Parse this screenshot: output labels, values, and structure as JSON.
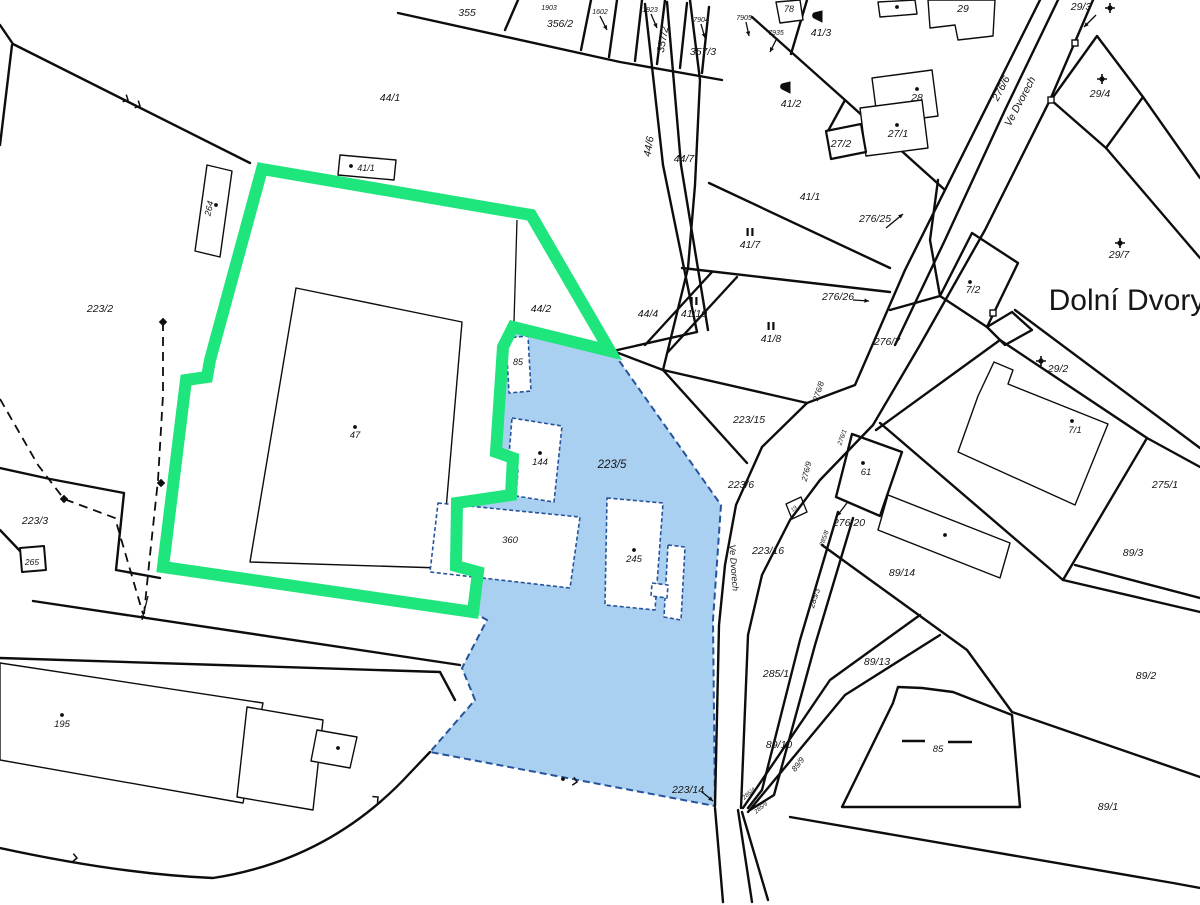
{
  "map": {
    "region_name": "Dolní Dvory",
    "highlight": {
      "parcel": "47",
      "color": "#1ee57c",
      "width": 12
    },
    "selection": {
      "parcel": "223/5",
      "fill": "#a9cff1",
      "border": "#26549b"
    },
    "line_color": "#0d0d0d",
    "street": "Ve Dvorech",
    "labels": [
      {
        "t": "355",
        "x": 467,
        "y": 16
      },
      {
        "t": "356/2",
        "x": 560,
        "y": 27
      },
      {
        "t": "357/2",
        "x": 666,
        "y": 40,
        "r": -80
      },
      {
        "t": "357/3",
        "x": 703,
        "y": 55
      },
      {
        "t": "1903",
        "x": 549,
        "y": 10,
        "s": 7
      },
      {
        "t": "1602",
        "x": 600,
        "y": 14,
        "s": 7
      },
      {
        "t": "1923",
        "x": 650,
        "y": 12,
        "s": 7
      },
      {
        "t": "7904",
        "x": 701,
        "y": 22,
        "s": 7
      },
      {
        "t": "7905",
        "x": 744,
        "y": 20,
        "s": 7
      },
      {
        "t": "7935",
        "x": 776,
        "y": 35,
        "s": 7
      },
      {
        "t": "78",
        "x": 789,
        "y": 12,
        "s": 9
      },
      {
        "t": "41/3",
        "x": 821,
        "y": 36
      },
      {
        "t": "29",
        "x": 963,
        "y": 12
      },
      {
        "t": "41/2",
        "x": 791,
        "y": 107
      },
      {
        "t": "28",
        "x": 917,
        "y": 101
      },
      {
        "t": "27/1",
        "x": 898,
        "y": 137
      },
      {
        "t": "27/2",
        "x": 841,
        "y": 147
      },
      {
        "t": "29/3",
        "x": 1081,
        "y": 10
      },
      {
        "t": "29/4",
        "x": 1100,
        "y": 97
      },
      {
        "t": "29/7",
        "x": 1119,
        "y": 258
      },
      {
        "t": "276/6",
        "x": 1004,
        "y": 90,
        "r": -62
      },
      {
        "t": "Ve Dvorech",
        "x": 1023,
        "y": 103,
        "r": -62
      },
      {
        "t": "44/1",
        "x": 390,
        "y": 101
      },
      {
        "t": "41/1",
        "x": 366,
        "y": 171,
        "s": 9
      },
      {
        "t": "264",
        "x": 212,
        "y": 209,
        "r": -78,
        "s": 9
      },
      {
        "t": "41/1",
        "x": 810,
        "y": 200
      },
      {
        "t": "276/25",
        "x": 875,
        "y": 222
      },
      {
        "t": "44/6",
        "x": 652,
        "y": 147,
        "r": -80
      },
      {
        "t": "44/7",
        "x": 684,
        "y": 162
      },
      {
        "t": "41/7",
        "x": 750,
        "y": 248
      },
      {
        "t": "223/2",
        "x": 100,
        "y": 312
      },
      {
        "t": "44/2",
        "x": 541,
        "y": 312
      },
      {
        "t": "276/26",
        "x": 838,
        "y": 300
      },
      {
        "t": "276/7",
        "x": 887,
        "y": 345
      },
      {
        "t": "7/2",
        "x": 973,
        "y": 293
      },
      {
        "t": "44/4",
        "x": 648,
        "y": 317
      },
      {
        "t": "41/10",
        "x": 694,
        "y": 317
      },
      {
        "t": "41/8",
        "x": 771,
        "y": 342
      },
      {
        "t": "223/15",
        "x": 749,
        "y": 423
      },
      {
        "t": "85",
        "x": 518,
        "y": 365,
        "s": 9
      },
      {
        "t": "223/5",
        "x": 612,
        "y": 468,
        "s": 11.5
      },
      {
        "t": "144",
        "x": 540,
        "y": 465,
        "s": 9.5
      },
      {
        "t": "29/2",
        "x": 1058,
        "y": 372
      },
      {
        "t": "7/1",
        "x": 1075,
        "y": 433,
        "s": 9.5
      },
      {
        "t": "276/8",
        "x": 821,
        "y": 392,
        "r": -72,
        "s": 8
      },
      {
        "t": "275/1",
        "x": 1165,
        "y": 488
      },
      {
        "t": "223/6",
        "x": 741,
        "y": 488
      },
      {
        "t": "61",
        "x": 866,
        "y": 475,
        "s": 9.5
      },
      {
        "t": "276/1",
        "x": 844,
        "y": 438,
        "r": -70,
        "s": 6.5
      },
      {
        "t": "19",
        "x": 795,
        "y": 510,
        "r": -40,
        "s": 5.5
      },
      {
        "t": "276/20",
        "x": 849,
        "y": 526
      },
      {
        "t": "360",
        "x": 510,
        "y": 543,
        "s": 9.5
      },
      {
        "t": "245",
        "x": 634,
        "y": 562,
        "s": 9.5
      },
      {
        "t": "223/16",
        "x": 768,
        "y": 554
      },
      {
        "t": "276/9",
        "x": 809,
        "y": 472,
        "r": -76,
        "s": 8
      },
      {
        "t": "285/8",
        "x": 826,
        "y": 539,
        "r": -70,
        "s": 6.5
      },
      {
        "t": "89/14",
        "x": 902,
        "y": 576
      },
      {
        "t": "285/3",
        "x": 817,
        "y": 599,
        "r": -72,
        "s": 8
      },
      {
        "t": "89/3",
        "x": 1133,
        "y": 556
      },
      {
        "t": "223/3",
        "x": 35,
        "y": 524
      },
      {
        "t": "265",
        "x": 32,
        "y": 565,
        "s": 8.5
      },
      {
        "t": "89/13",
        "x": 877,
        "y": 665
      },
      {
        "t": "89/2",
        "x": 1146,
        "y": 679
      },
      {
        "t": "285/1",
        "x": 776,
        "y": 677
      },
      {
        "t": "Ve Dvorech",
        "x": 731,
        "y": 568,
        "r": 86,
        "s": 9
      },
      {
        "t": "89/10",
        "x": 779,
        "y": 748
      },
      {
        "t": "89/9",
        "x": 800,
        "y": 766,
        "r": -52,
        "s": 8
      },
      {
        "t": "285/4",
        "x": 750,
        "y": 795,
        "r": -40,
        "s": 6
      },
      {
        "t": "285/9",
        "x": 762,
        "y": 809,
        "r": -40,
        "s": 6
      },
      {
        "t": "195",
        "x": 62,
        "y": 727,
        "s": 9.5
      },
      {
        "t": "223/14",
        "x": 688,
        "y": 793
      },
      {
        "t": "85",
        "x": 938,
        "y": 752,
        "s": 9.5
      },
      {
        "t": "89/1",
        "x": 1108,
        "y": 810
      },
      {
        "t": "47",
        "x": 355,
        "y": 438,
        "s": 9.5
      },
      {
        "t": "Dolní Dvory",
        "x": 1127,
        "y": 310,
        "s": 30,
        "it": 0
      }
    ],
    "symbols": {
      "dots": [
        [
          351,
          166
        ],
        [
          897,
          7
        ],
        [
          917,
          89
        ],
        [
          897,
          125
        ],
        [
          355,
          427
        ],
        [
          540,
          453
        ],
        [
          634,
          550
        ],
        [
          338,
          748
        ],
        [
          62,
          715
        ],
        [
          1072,
          421
        ],
        [
          863,
          463
        ],
        [
          945,
          535
        ],
        [
          970,
          282
        ],
        [
          563,
          779
        ],
        [
          216,
          205
        ]
      ],
      "crosses": [
        [
          1110,
          8
        ],
        [
          1102,
          79
        ],
        [
          1120,
          243
        ],
        [
          1041,
          361
        ]
      ],
      "flags": [
        [
          822,
          22
        ],
        [
          790,
          93
        ]
      ],
      "bar_pairs": [
        [
          750,
          236
        ],
        [
          694,
          305
        ],
        [
          771,
          330
        ]
      ],
      "diamonds": [
        [
          163,
          322
        ],
        [
          161,
          483
        ],
        [
          64,
          499
        ]
      ],
      "squares": [
        [
          1075,
          43
        ],
        [
          1051,
          100
        ],
        [
          993,
          313
        ]
      ],
      "dashes": [
        [
          902,
          741,
          925,
          741
        ],
        [
          948,
          742,
          972,
          742
        ]
      ],
      "arrows": [
        [
          886,
          228,
          903,
          214
        ],
        [
          853,
          300,
          869,
          301
        ],
        [
          1096,
          15,
          1084,
          27
        ],
        [
          847,
          503,
          837,
          516
        ],
        [
          702,
          792,
          713,
          801
        ],
        [
          600,
          16,
          607,
          30
        ],
        [
          651,
          14,
          657,
          28
        ],
        [
          701,
          24,
          705,
          38
        ],
        [
          746,
          22,
          749,
          36
        ],
        [
          777,
          38,
          770,
          52
        ],
        [
          148,
          596,
          142,
          620
        ]
      ],
      "ticks": [
        [
          128,
          100,
          27
        ],
        [
          140,
          106,
          27
        ],
        [
          77,
          858,
          5
        ],
        [
          378,
          797,
          -40
        ],
        [
          577,
          782,
          12
        ]
      ]
    }
  }
}
